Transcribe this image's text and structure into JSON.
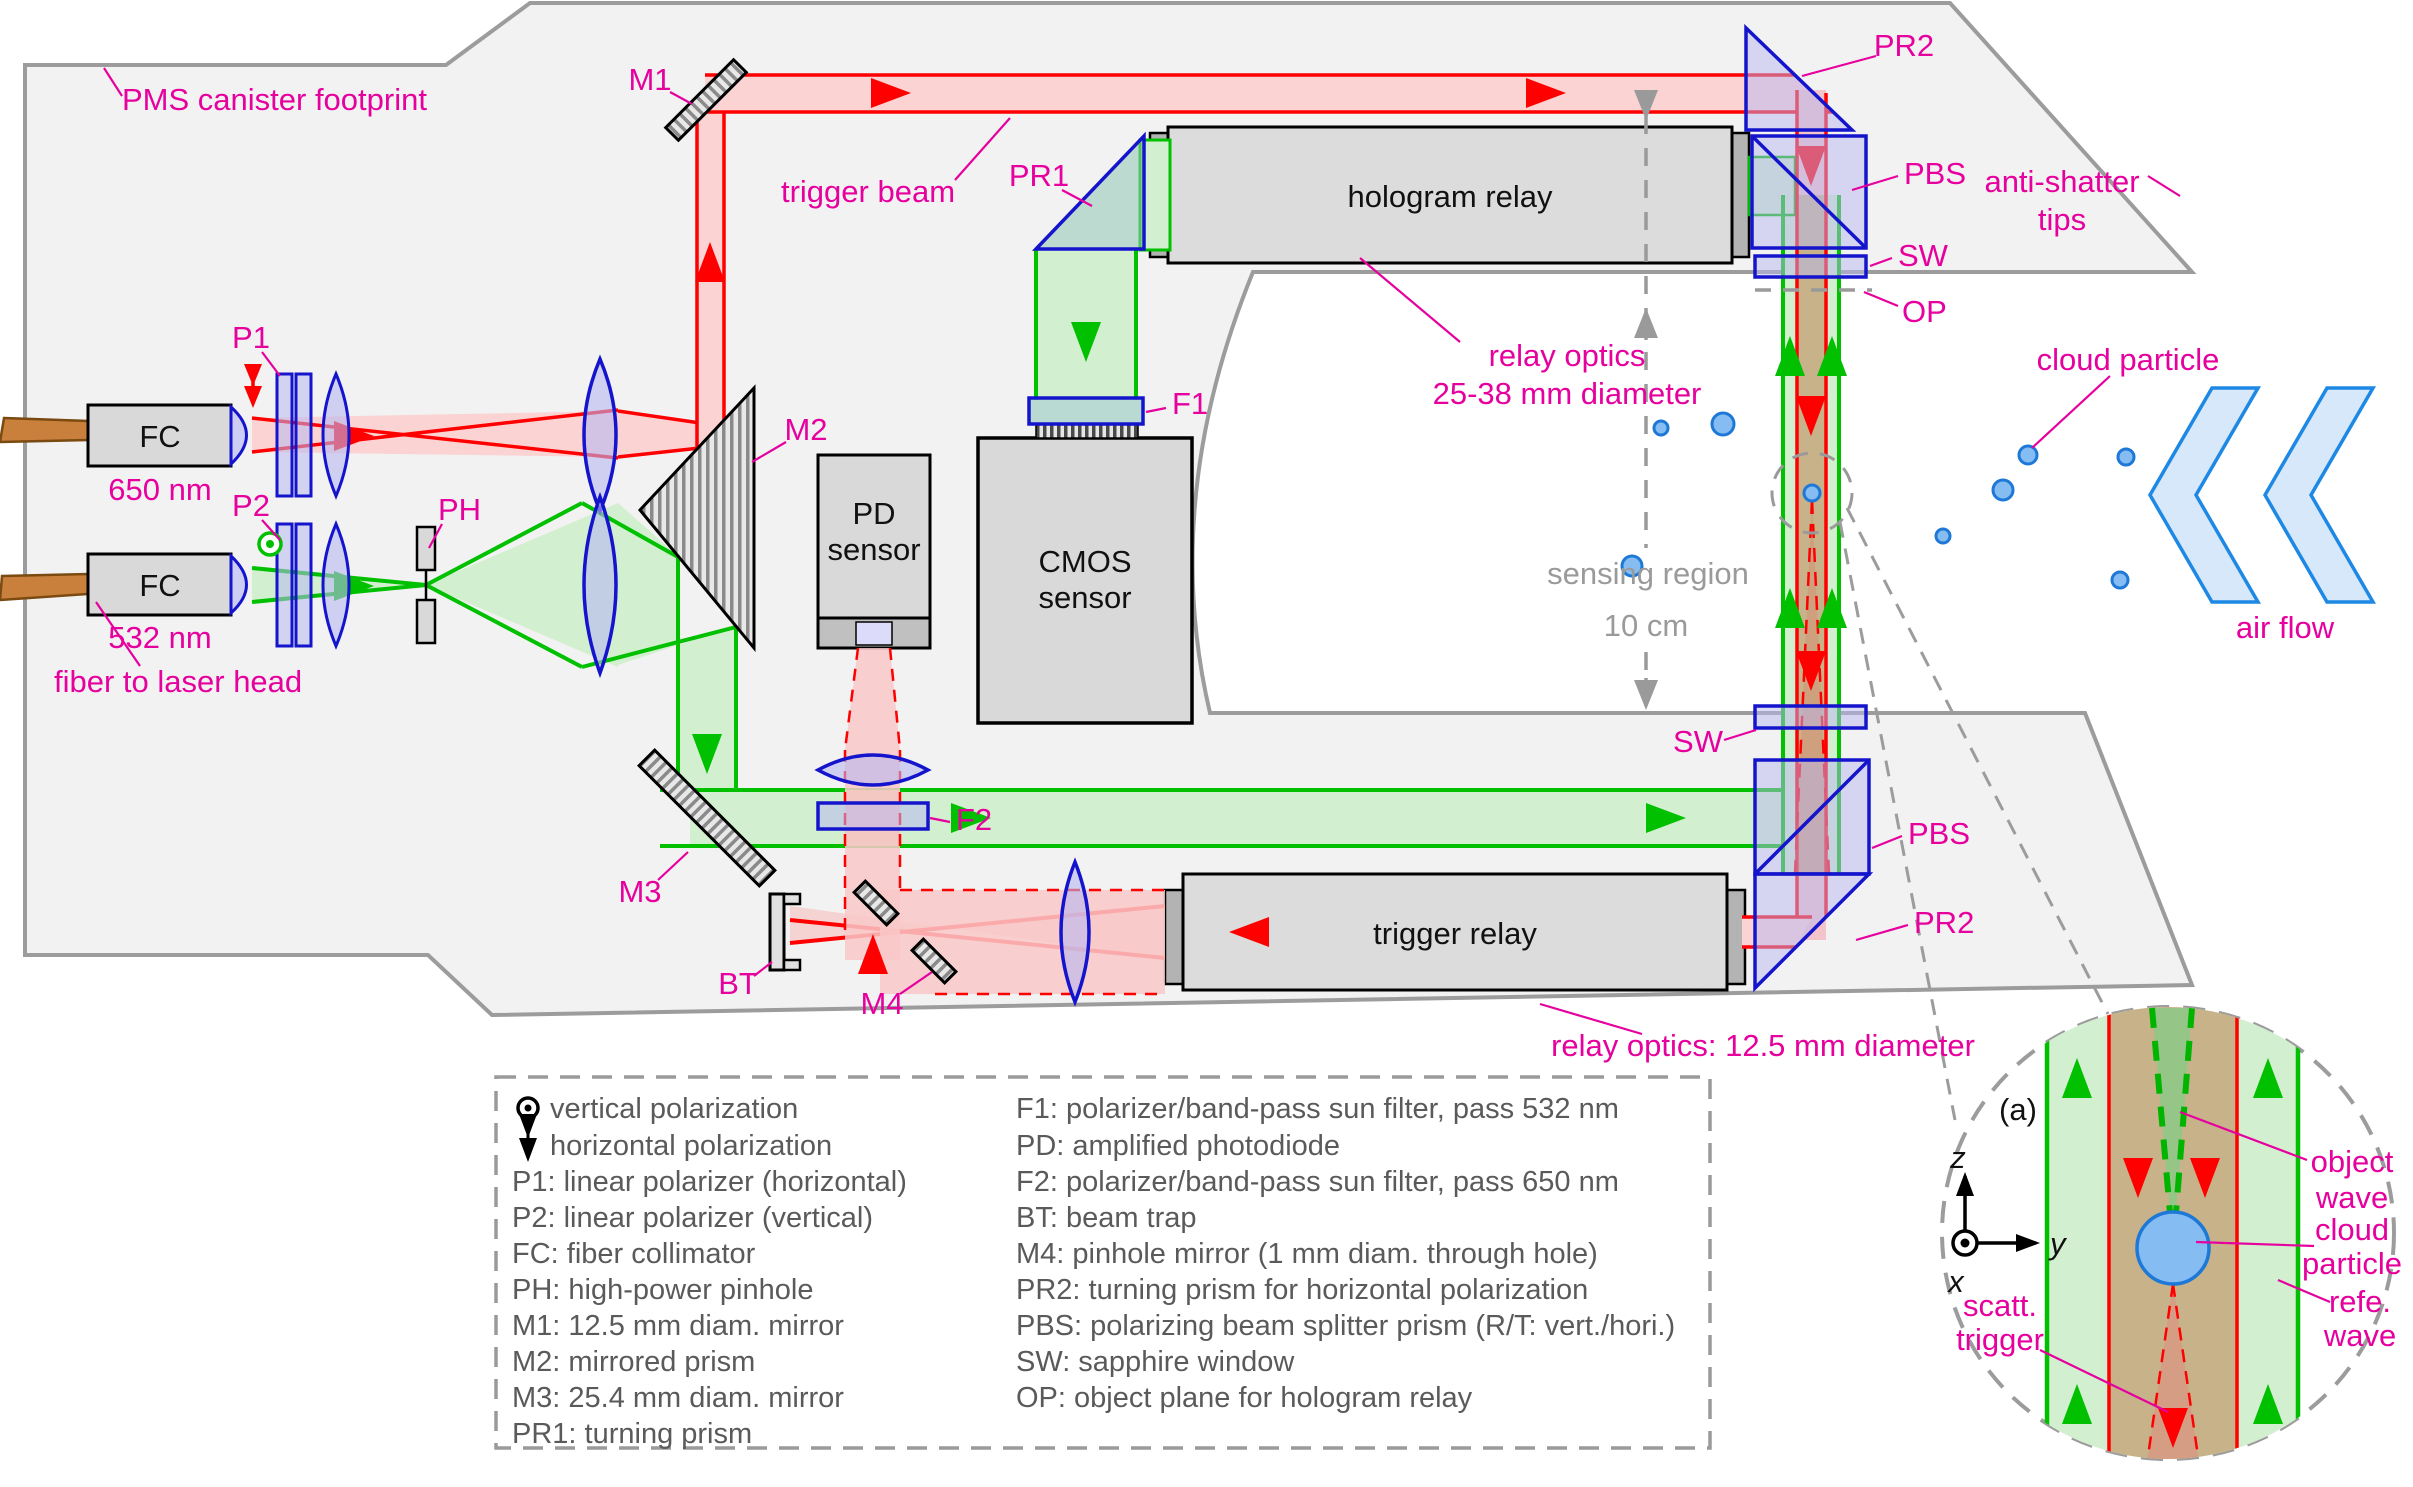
{
  "title": "Holographic cloud particle instrument optical layout",
  "colors": {
    "magenta_label": "#e6009e",
    "beam_red": "#ff0000",
    "beam_green": "#00c000",
    "optics_blue": "#1414cc",
    "overlap_tan": "#c7b289",
    "canister_gray": "#f2f2f2",
    "particle_blue": "#85bdf2"
  },
  "labels": {
    "pms": "PMS canister footprint",
    "m1": "M1",
    "trigger_beam": "trigger beam",
    "pr1": "PR1",
    "hologram_relay": "hologram relay",
    "relay_optics_top": [
      "relay optics",
      "25-38 mm diameter"
    ],
    "pr2_top": "PR2",
    "pbs_top": "PBS",
    "sw_top": "SW",
    "op": "OP",
    "anti_shatter": [
      "anti-shatter",
      "tips"
    ],
    "f1": "F1",
    "m2": "M2",
    "p1": "P1",
    "p2": "P2",
    "ph": "PH",
    "fc": "FC",
    "nm650": "650 nm",
    "nm532": "532 nm",
    "fiber": "fiber to laser head",
    "pd": [
      "PD",
      "sensor"
    ],
    "cmos": [
      "CMOS",
      "sensor"
    ],
    "sensing": [
      "sensing region",
      "10 cm"
    ],
    "cloud_particle": "cloud particle",
    "air_flow": "air flow",
    "m3": "M3",
    "bt": "BT",
    "m4": "M4",
    "f2": "F2",
    "trigger_relay": "trigger relay",
    "relay_optics_bottom": "relay optics: 12.5 mm diameter",
    "sw_bottom": "SW",
    "pbs_bottom": "PBS",
    "pr2_bottom": "PR2"
  },
  "legend": {
    "left": [
      "vertical polarization",
      "horizontal polarization",
      "P1: linear polarizer (horizontal)",
      "P2: linear polarizer (vertical)",
      "FC: fiber collimator",
      "PH: high-power pinhole",
      "M1: 12.5 mm diam. mirror",
      "M2: mirrored prism",
      "M3: 25.4 mm diam. mirror",
      "PR1: turning prism"
    ],
    "right": [
      "F1: polarizer/band-pass sun filter, pass 532 nm",
      "PD: amplified photodiode",
      "F2: polarizer/band-pass sun filter, pass 650 nm",
      "BT: beam trap",
      "M4: pinhole mirror (1 mm diam. through hole)",
      "PR2: turning prism for horizontal polarization",
      "PBS: polarizing beam splitter prism (R/T: vert./hori.)",
      "SW: sapphire window",
      "OP: object plane for hologram relay"
    ]
  },
  "inset": {
    "a": "(a)",
    "z": "z",
    "y": "y",
    "x": "x",
    "object_wave": [
      "object",
      "wave"
    ],
    "cloud": [
      "cloud",
      "particle"
    ],
    "refe": [
      "refe.",
      "wave"
    ],
    "scatt": [
      "scatt.",
      "trigger"
    ]
  }
}
